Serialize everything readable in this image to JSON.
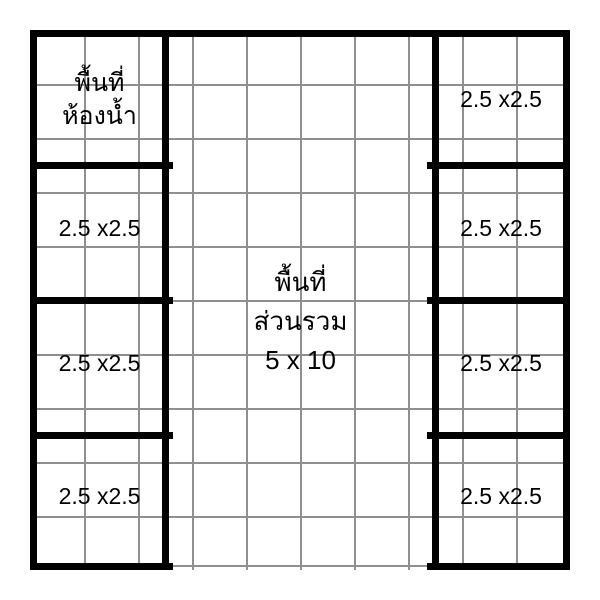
{
  "floor_plan": {
    "colors": {
      "wall": "#000000",
      "grid_line": "#8f8f8f",
      "background": "#ffffff",
      "text": "#000000"
    },
    "grid": {
      "columns": 10,
      "rows": 10
    },
    "bathroom": {
      "line1": "พื้นที่",
      "line2": "ห้องน้ำ"
    },
    "left_rooms": [
      {
        "label": "2.5 x2.5"
      },
      {
        "label": "2.5 x2.5"
      },
      {
        "label": "2.5 x2.5"
      }
    ],
    "right_rooms": [
      {
        "label": "2.5 x2.5"
      },
      {
        "label": "2.5 x2.5"
      },
      {
        "label": "2.5 x2.5"
      },
      {
        "label": "2.5 x2.5"
      }
    ],
    "common_area": {
      "line1": "พื้นที่",
      "line2": "ส่วนรวม",
      "line3": "5 x 10"
    }
  }
}
